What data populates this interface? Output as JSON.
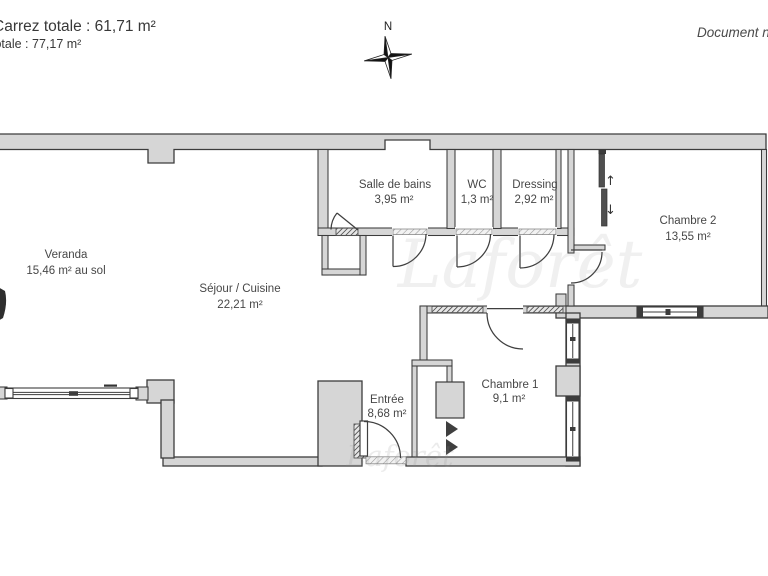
{
  "header": {
    "surface_line_1": "Carrez totale : 61,71 m²",
    "surface_line_2": "totale : 77,17 m²",
    "document_note": "Document n",
    "compass_label": "N"
  },
  "watermark": {
    "text": "Laforêt"
  },
  "rooms": [
    {
      "name": "Veranda",
      "area": "15,46 m² au sol"
    },
    {
      "name": "Séjour / Cuisine",
      "area": "22,21 m²"
    },
    {
      "name": "Salle de bains",
      "area": "3,95 m²"
    },
    {
      "name": "WC",
      "area": "1,3 m²"
    },
    {
      "name": "Dressing",
      "area": "2,92 m²"
    },
    {
      "name": "Chambre 2",
      "area": "13,55 m²"
    },
    {
      "name": "Chambre 1",
      "area": "9,1 m²"
    },
    {
      "name": "Entrée",
      "area": "8,68 m²"
    }
  ],
  "annotations": {
    "slide_up": "↑",
    "slide_down": "↓"
  },
  "colors": {
    "wall_fill": "#d6d6d6",
    "wall_stroke": "#3c3c3c",
    "label_text": "#474747",
    "header_text": "#383838"
  }
}
